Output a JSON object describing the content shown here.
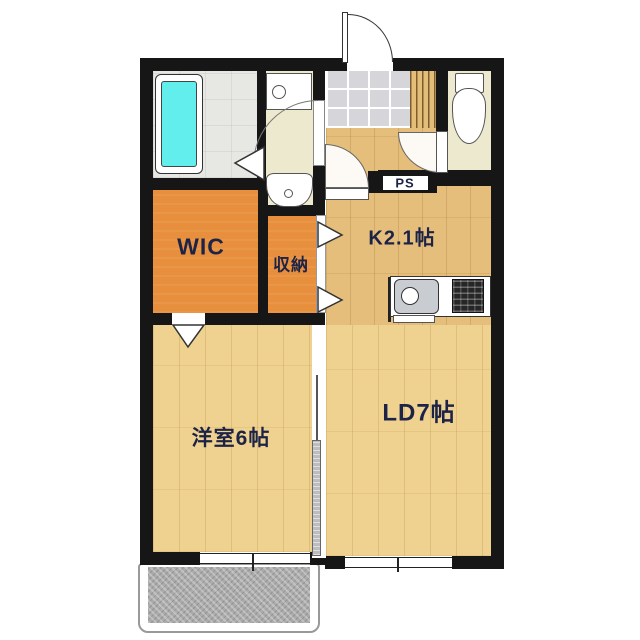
{
  "rooms": {
    "wic": {
      "label": "WIC"
    },
    "storage": {
      "label": "収納"
    },
    "kitchen": {
      "label": "K2.1帖"
    },
    "living_dining": {
      "label": "LD7帖"
    },
    "western_room": {
      "label": "洋室6帖"
    },
    "pipe_space": {
      "label": "PS"
    }
  },
  "fixtures": [
    "bathtub",
    "washing-machine-pan",
    "washbasin",
    "toilet",
    "kitchen-sink",
    "gas-stove",
    "balcony",
    "entrance-door",
    "sliding-door",
    "folding-doors"
  ],
  "colors": {
    "wall": "#161616",
    "floor_wood_tan": "#E5BE7B",
    "floor_wood_wheat": "#EFD28F",
    "closet_orange": "#E78F3C",
    "sanitary_cream": "#ECE9CF",
    "bathroom_gray": "#E7E7E3",
    "entrance_tile": "#D6D5DA",
    "bathtub_cyan": "#63EEEE",
    "balcony_gray": "#ABABAB",
    "label_navy": "#1D2347"
  }
}
